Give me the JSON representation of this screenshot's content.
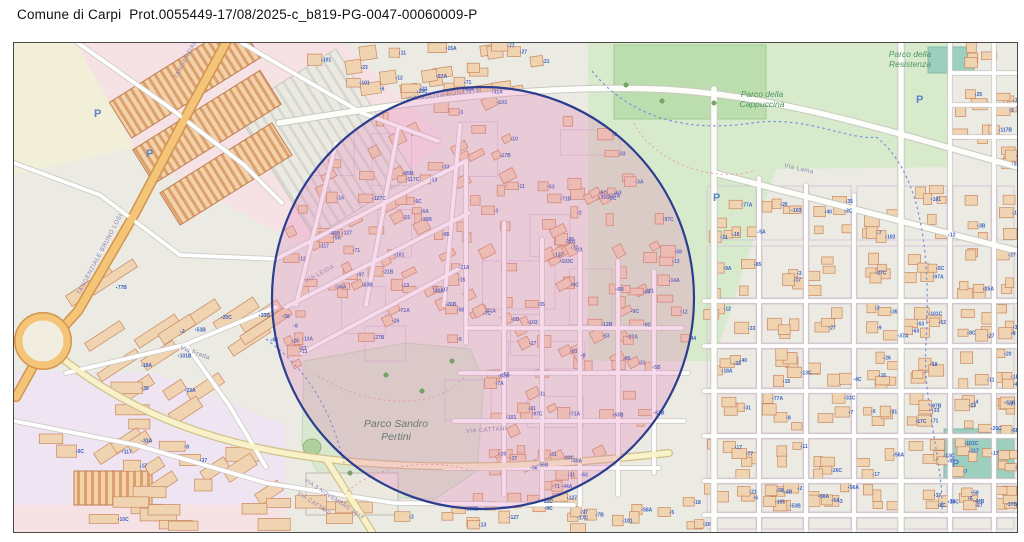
{
  "header": {
    "title": "Comune di Carpi  Prot.0055449-17/08/2025-c_b819-PG-0047-00060009-P"
  },
  "map": {
    "palette": {
      "background": "#EBEAE3",
      "park_green": "#D7EBCC",
      "sport_teal": "#9CCFBD",
      "building_fill": "#F0D4B2",
      "building_stroke": "#C9875F",
      "house_number_blue": "#3C63C2",
      "street_label": "#8585AE",
      "trunk_orange": "#F4C478",
      "secondary_yellow": "#F8F1C9",
      "selection_fill": "rgba(226,122,182,0.28)",
      "selection_stroke": "#2C3E8E",
      "park_label_green": "#4E9560",
      "parking_blue": "#5B84C4"
    },
    "selection_circle": {
      "cx": 469,
      "cy": 255,
      "r": 211
    },
    "zones": [
      {
        "shape": "rect",
        "x": 0,
        "y": 0,
        "w": 1003,
        "h": 489,
        "fill": "#EBEAE3"
      },
      {
        "shape": "poly",
        "pts": "0,0 210,0 150,98 0,132",
        "fill": "#F1EFD7"
      },
      {
        "shape": "poly",
        "pts": "62,0 330,0 432,98 295,205 128,118",
        "fill": "#F6E2E5"
      },
      {
        "shape": "poly",
        "pts": "0,328 140,330 272,382 272,462 0,462",
        "fill": "#EFE4F1"
      },
      {
        "shape": "rect",
        "x": 0,
        "y": 462,
        "w": 272,
        "h": 27,
        "fill": "#F6E2E5"
      },
      {
        "shape": "poly",
        "pts": "574,0 938,0 938,124 762,126 700,318 574,318",
        "fill": "#D7EBCC"
      },
      {
        "shape": "rect",
        "x": 600,
        "y": 2,
        "w": 152,
        "h": 74,
        "fill": "#BCDDAD",
        "stroke": "#A3CB93"
      },
      {
        "shape": "poly",
        "pts": "290,318 392,300 456,306 470,338 463,428 421,456 318,453 288,402",
        "fill": "#D9E7D0",
        "stroke": "#C4D8BA"
      },
      {
        "shape": "rect",
        "x": 914,
        "y": 4,
        "w": 46,
        "h": 26,
        "fill": "#9CCFBD",
        "stroke": "#82B9A6"
      },
      {
        "shape": "rect",
        "x": 930,
        "y": 386,
        "w": 70,
        "h": 50,
        "fill": "#9CCFBD",
        "stroke": "#82B9A6"
      },
      {
        "shape": "rect",
        "x": 252,
        "y": 26,
        "w": 118,
        "h": 148,
        "rot": -32,
        "fill": "url(#pstripe)",
        "stroke": "#C8C8C0"
      },
      {
        "shape": "rect",
        "x": 95,
        "y": 16,
        "w": 152,
        "h": 42,
        "rot": -32,
        "fill": "url(#hatch)",
        "stroke": "#BE7E52"
      },
      {
        "shape": "rect",
        "x": 118,
        "y": 64,
        "w": 150,
        "h": 40,
        "rot": -32,
        "fill": "url(#hatch)",
        "stroke": "#BE7E52"
      },
      {
        "shape": "rect",
        "x": 146,
        "y": 112,
        "w": 132,
        "h": 38,
        "rot": -32,
        "fill": "url(#hatch)",
        "stroke": "#BE7E52"
      },
      {
        "shape": "rect",
        "x": 292,
        "y": 430,
        "w": 92,
        "h": 42,
        "fill": "#ECE9E1",
        "stroke": "#BDBDB5"
      },
      {
        "shape": "rect",
        "x": 60,
        "y": 428,
        "w": 78,
        "h": 34,
        "fill": "url(#hatch)",
        "stroke": "#BE7E52"
      },
      {
        "shape": "ellipse",
        "cx": 298,
        "cy": 404,
        "rx": 9,
        "ry": 8,
        "fill": "#AFCF9B",
        "stroke": "#8FB57E"
      }
    ],
    "roads": [
      {
        "d": "M265,80 C400,58 520,42 640,46 C760,50 880,90 1003,124",
        "cls": "white"
      },
      {
        "d": "M700,46 L700,489",
        "cls": "white"
      },
      {
        "d": "M887,0 L887,489",
        "cls": "white"
      },
      {
        "d": "M700,130 L1003,208",
        "cls": "white"
      },
      {
        "d": "M745,135 L745,489",
        "cls": "minor"
      },
      {
        "d": "M792,142 L792,489",
        "cls": "minor"
      },
      {
        "d": "M840,152 L840,489",
        "cls": "minor"
      },
      {
        "d": "M936,0 L936,489",
        "cls": "minor"
      },
      {
        "d": "M980,0 L980,489",
        "cls": "minor"
      },
      {
        "d": "M690,258 L1003,258",
        "cls": "minor"
      },
      {
        "d": "M690,303 L1003,303",
        "cls": "minor"
      },
      {
        "d": "M690,348 L1003,348",
        "cls": "minor"
      },
      {
        "d": "M690,393 L1003,393",
        "cls": "minor"
      },
      {
        "d": "M690,438 L1003,438",
        "cls": "minor"
      },
      {
        "d": "M690,472 L1003,472",
        "cls": "minor"
      },
      {
        "d": "M938,30 L1003,30",
        "cls": "minor"
      },
      {
        "d": "M938,62 L1003,62",
        "cls": "minor"
      },
      {
        "d": "M938,94 L1003,94",
        "cls": "minor"
      },
      {
        "d": "M262,216 L452,118",
        "cls": "minor"
      },
      {
        "d": "M272,264 L455,170",
        "cls": "minor"
      },
      {
        "d": "M288,310 L452,222",
        "cls": "minor"
      },
      {
        "d": "M322,100 L282,262",
        "cls": "minor"
      },
      {
        "d": "M384,86 L352,262",
        "cls": "minor"
      },
      {
        "d": "M446,82 L430,262",
        "cls": "minor"
      },
      {
        "d": "M452,118 L452,300",
        "cls": "minor"
      },
      {
        "d": "M490,180 L490,452",
        "cls": "minor"
      },
      {
        "d": "M528,196 L528,460",
        "cls": "minor"
      },
      {
        "d": "M566,208 L566,462",
        "cls": "minor"
      },
      {
        "d": "M604,218 L604,452",
        "cls": "minor"
      },
      {
        "d": "M640,228 L640,430",
        "cls": "minor"
      },
      {
        "d": "M452,285 L668,285",
        "cls": "minor"
      },
      {
        "d": "M446,330 L674,330",
        "cls": "minor"
      },
      {
        "d": "M440,378 L670,378",
        "cls": "minor"
      },
      {
        "d": "M430,425 L645,425",
        "cls": "minor"
      },
      {
        "d": "M52,330 L170,302 L262,264",
        "cls": "minor"
      },
      {
        "d": "M172,302 L215,362 L252,424",
        "cls": "minor"
      },
      {
        "d": "M228,0 L348,70 L424,98",
        "cls": "minor"
      },
      {
        "d": "M64,0 L152,62 L230,122 L268,160",
        "cls": "minor"
      },
      {
        "d": "M0,120 L86,152 L166,212 L262,216",
        "cls": "minor"
      },
      {
        "d": "M0,378 L122,402 L252,440 L380,460 L560,462",
        "cls": "minor"
      },
      {
        "d": "M44,312 C120,374 210,404 312,416 C430,430 545,422 655,410",
        "cls": "yellow"
      },
      {
        "d": "M312,416 L358,489",
        "cls": "yellow"
      },
      {
        "d": "M214,-4 L178,62 L120,172 L64,268 L44,290",
        "cls": "trunk"
      },
      {
        "d": "M22,318 L2,354",
        "cls": "trunk"
      }
    ],
    "roundabout": {
      "cx": 29,
      "cy": 298,
      "r": 24
    },
    "canals": [
      {
        "d": "M578,28 C622,82 686,88 738,80 C792,72 836,98 862,94"
      },
      {
        "d": "M862,94 C902,124 918,196 912,300"
      },
      {
        "d": "M912,300 C908,360 930,420 928,470"
      },
      {
        "d": "M252,296 C298,330 318,372 330,420"
      }
    ],
    "footpaths": [
      {
        "d": "M300,330 C345,362 420,372 452,332"
      },
      {
        "d": "M330,452 C360,420 420,415 460,428"
      },
      {
        "d": "M620,80 C640,120 700,140 740,128"
      }
    ],
    "street_labels": [
      {
        "text": "TANGENZIALE BRUNO LOSI",
        "x": 163,
        "y": 36,
        "rot": -62,
        "size": 6,
        "color": "#8F83B5"
      },
      {
        "text": "TANGENZIALE BRUNO LOSI",
        "x": 66,
        "y": 252,
        "rot": -62,
        "size": 6,
        "color": "#8F83B5"
      },
      {
        "text": "VIA NUOVA PONENTE",
        "x": 392,
        "y": 58,
        "rot": -7,
        "size": 6.5,
        "color": "#8585AE"
      },
      {
        "text": "Via Lama",
        "x": 770,
        "y": 124,
        "rot": 13,
        "size": 6.2,
        "color": "#8585AE"
      },
      {
        "text": "VIA LEIDA",
        "x": 292,
        "y": 240,
        "rot": -28,
        "size": 6,
        "color": "#8585AE"
      },
      {
        "text": "Via Frada",
        "x": 166,
        "y": 306,
        "rot": 20,
        "size": 6.2,
        "color": "#8585AE"
      },
      {
        "text": "VIA CATTANI",
        "x": 452,
        "y": 390,
        "rot": -4,
        "size": 6,
        "color": "#8585AE"
      },
      {
        "text": "VIA 3 NOVEMBRE 1918",
        "x": 290,
        "y": 438,
        "rot": 33,
        "size": 5.6,
        "color": "#8F83B5"
      },
      {
        "text": "VIA CATTANI",
        "x": 283,
        "y": 451,
        "rot": 33,
        "size": 5.6,
        "color": "#8F83B5"
      }
    ],
    "park_labels": [
      {
        "lines": [
          "Parco della",
          "Resistenza"
        ],
        "x": 896,
        "y": 14,
        "size": 8.5,
        "color": "#4E9560",
        "lh": 10
      },
      {
        "lines": [
          "Parco della",
          "Cappuccina"
        ],
        "x": 748,
        "y": 54,
        "size": 8.5,
        "color": "#4E9560",
        "lh": 10
      },
      {
        "lines": [
          "Parco Sandro",
          "Pertini"
        ],
        "x": 382,
        "y": 384,
        "size": 10.5,
        "color": "#6A7A6E",
        "lh": 13
      }
    ],
    "parking_markers": [
      {
        "x": 80,
        "y": 74
      },
      {
        "x": 132,
        "y": 114
      },
      {
        "x": 699,
        "y": 158
      },
      {
        "x": 902,
        "y": 60
      },
      {
        "x": 938,
        "y": 424
      }
    ],
    "trees": [
      {
        "x": 372,
        "y": 332
      },
      {
        "x": 408,
        "y": 348
      },
      {
        "x": 438,
        "y": 318
      },
      {
        "x": 612,
        "y": 42
      },
      {
        "x": 648,
        "y": 58
      },
      {
        "x": 700,
        "y": 60
      },
      {
        "x": 336,
        "y": 430
      }
    ],
    "house_numbers_pool": [
      "1",
      "2",
      "3",
      "4",
      "5",
      "6",
      "7",
      "8",
      "9",
      "10",
      "11",
      "12",
      "13",
      "14",
      "15",
      "16",
      "17",
      "18",
      "20",
      "21",
      "23",
      "25",
      "26",
      "27",
      "31",
      "33",
      "35",
      "37",
      "40",
      "44",
      "53",
      "56",
      "58",
      "63",
      "71",
      "77",
      "85",
      "97",
      "101",
      "103",
      "117",
      "127"
    ],
    "house_number_suffixes": [
      "",
      "",
      "",
      "",
      "A",
      "B",
      "C"
    ],
    "building_regions": [
      {
        "type": "grid",
        "vxs": [
          690,
          745,
          792,
          840,
          887,
          936,
          980,
          1003
        ],
        "hys": [
          140,
          200,
          258,
          303,
          348,
          393,
          438,
          472,
          489
        ],
        "min": 3,
        "max": 6,
        "numProb": 0.5
      },
      {
        "type": "scatter",
        "clip": "circle",
        "x0": 262,
        "y0": 58,
        "x1": 678,
        "y1": 452,
        "count": 300,
        "w0": 7,
        "w1": 16,
        "h0": 6,
        "h1": 12,
        "rots": [
          -27,
          -27,
          0,
          0,
          0
        ],
        "numProb": 0.55,
        "avoid": [
          285,
          298,
          472,
          458
        ]
      },
      {
        "type": "scatter",
        "x0": 55,
        "y0": 232,
        "x1": 265,
        "y1": 345,
        "count": 13,
        "w0": 36,
        "w1": 58,
        "h0": 9,
        "h1": 13,
        "rots": [
          -33
        ],
        "numProb": 0.45
      },
      {
        "type": "scatter",
        "x0": 10,
        "y0": 342,
        "x1": 268,
        "y1": 455,
        "count": 22,
        "w0": 16,
        "w1": 34,
        "h0": 9,
        "h1": 15,
        "rots": [
          -33,
          0
        ],
        "numProb": 0.4
      },
      {
        "type": "scatter",
        "x0": 30,
        "y0": 458,
        "x1": 380,
        "y1": 484,
        "count": 14,
        "w0": 20,
        "w1": 40,
        "h0": 8,
        "h1": 13,
        "rots": [
          0
        ],
        "numProb": 0.3
      },
      {
        "type": "scatter",
        "x0": 300,
        "y0": 2,
        "x1": 565,
        "y1": 50,
        "count": 26,
        "w0": 10,
        "w1": 20,
        "h0": 8,
        "h1": 14,
        "rots": [
          0,
          -8
        ],
        "numProb": 0.5
      },
      {
        "type": "scatter",
        "x0": 940,
        "y0": 2,
        "x1": 1000,
        "y1": 124,
        "count": 20,
        "w0": 9,
        "w1": 16,
        "h0": 7,
        "h1": 12,
        "rots": [
          0
        ],
        "numProb": 0.5
      },
      {
        "type": "scatter",
        "x0": 382,
        "y0": 454,
        "x1": 688,
        "y1": 486,
        "count": 26,
        "w0": 9,
        "w1": 16,
        "h0": 7,
        "h1": 12,
        "rots": [
          0
        ],
        "numProb": 0.5
      }
    ]
  }
}
